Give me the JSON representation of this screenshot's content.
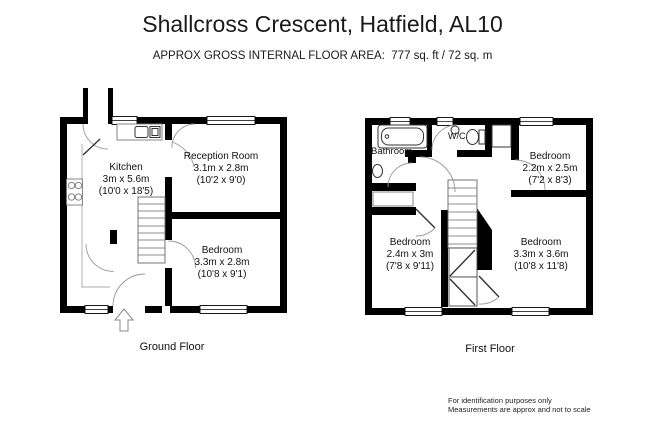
{
  "colors": {
    "ink": "#1a1a1a",
    "background": "#ffffff",
    "walls": "#000000"
  },
  "header": {
    "title": "Shallcross Crescent, Hatfield, AL10",
    "subtitle": "APPROX GROSS INTERNAL FLOOR AREA:  777 sq. ft / 72 sq. m"
  },
  "ground_floor": {
    "caption": "Ground Floor",
    "rooms": {
      "kitchen": {
        "name": "Kitchen",
        "metric": "3m x 5.6m",
        "imperial": "(10'0 x 18'5)"
      },
      "reception": {
        "name": "Reception Room",
        "metric": "3.1m x 2.8m",
        "imperial": "(10'2 x 9'0)"
      },
      "bedroom": {
        "name": "Bedroom",
        "metric": "3.3m x 2.8m",
        "imperial": "(10'8 x 9'1)"
      }
    }
  },
  "first_floor": {
    "caption": "First Floor",
    "rooms": {
      "bathroom": {
        "name": "Bathroom"
      },
      "wc": {
        "name": "W/C"
      },
      "bedroom_small": {
        "name": "Bedroom",
        "metric": "2.2m x 2.5m",
        "imperial": "(7'2 x 8'3)"
      },
      "bedroom_mid": {
        "name": "Bedroom",
        "metric": "2.4m x 3m",
        "imperial": "(7'8 x 9'11)"
      },
      "bedroom_large": {
        "name": "Bedroom",
        "metric": "3.3m x 3.6m",
        "imperial": "(10'8 x 11'8)"
      }
    }
  },
  "disclaimer": {
    "line1": "For identification purposes only",
    "line2": "Measurements are approx and not to scale"
  }
}
